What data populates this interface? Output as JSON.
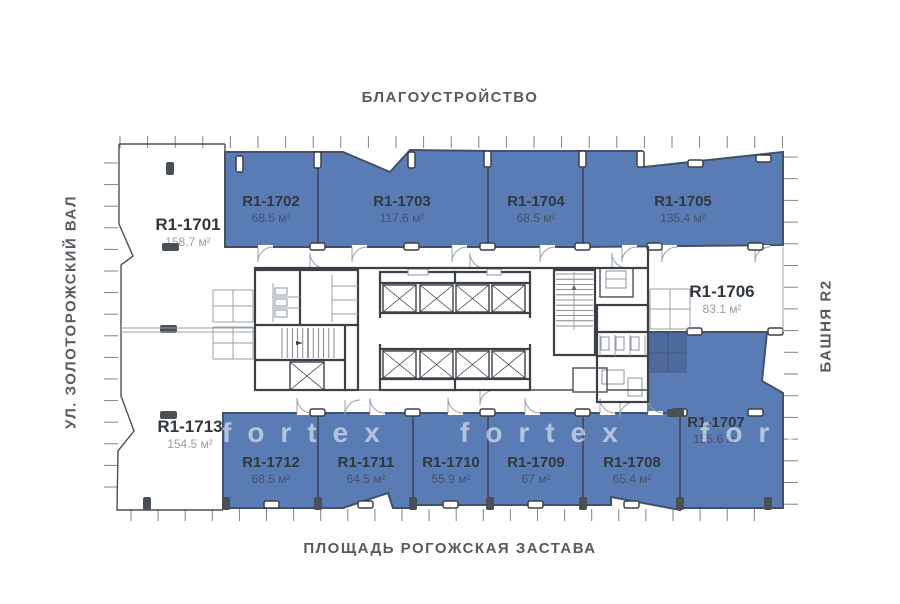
{
  "labels": {
    "top": "БЛАГОУСТРОЙСТВО",
    "left": "УЛ. ЗОЛОТОРОЖСКИЙ ВАЛ",
    "right": "БАШНЯ R2",
    "bottom": "ПЛОЩАДЬ РОГОЖСКАЯ ЗАСТАВА"
  },
  "watermark": {
    "text": "fortex",
    "tiles": [
      {
        "x": 222,
        "y": 442
      },
      {
        "x": 460,
        "y": 442
      },
      {
        "x": 700,
        "y": 442
      }
    ]
  },
  "colors": {
    "highlight_fill": "#5a7cb5",
    "highlight_border": "#43506a",
    "wall": "#3b4046",
    "unit_id_text": "#31373f",
    "area_text_on_blue": "#46526a",
    "area_text_on_white": "#989da5",
    "margin_label_text": "#565a61",
    "watermark_text": "rgba(255,255,255,0.55)"
  },
  "units": [
    {
      "id": "R1-1701",
      "area": "158.7 м²",
      "highlighted": false,
      "label": {
        "x": 188,
        "y": 230
      },
      "polygon": null
    },
    {
      "id": "R1-1702",
      "area": "68.5 м²",
      "highlighted": true,
      "label": {
        "x": 271,
        "y": 206
      },
      "polygon": [
        [
          225,
          152
        ],
        [
          318,
          152
        ],
        [
          318,
          247
        ],
        [
          225,
          247
        ]
      ]
    },
    {
      "id": "R1-1703",
      "area": "117.6 м²",
      "highlighted": true,
      "label": {
        "x": 402,
        "y": 206
      },
      "polygon": [
        [
          318,
          152
        ],
        [
          343,
          152
        ],
        [
          390,
          172
        ],
        [
          410,
          150
        ],
        [
          488,
          151
        ],
        [
          488,
          247
        ],
        [
          318,
          247
        ]
      ]
    },
    {
      "id": "R1-1704",
      "area": "68.5 м²",
      "highlighted": true,
      "label": {
        "x": 536,
        "y": 206
      },
      "polygon": [
        [
          488,
          151
        ],
        [
          583,
          151
        ],
        [
          583,
          247
        ],
        [
          488,
          247
        ]
      ]
    },
    {
      "id": "R1-1705",
      "area": "135.4 м²",
      "highlighted": true,
      "label": {
        "x": 683,
        "y": 206
      },
      "polygon": [
        [
          583,
          151
        ],
        [
          641,
          151
        ],
        [
          644,
          167
        ],
        [
          783,
          152
        ],
        [
          783,
          245
        ],
        [
          583,
          247
        ]
      ]
    },
    {
      "id": "R1-1706",
      "area": "83.1 м²",
      "highlighted": false,
      "label": {
        "x": 722,
        "y": 297
      },
      "polygon": null
    },
    {
      "id": "R1-1707",
      "area": "155.6 м²",
      "highlighted": true,
      "label": {
        "x": 716,
        "y": 427
      },
      "polygon": [
        [
          648,
          332
        ],
        [
          767,
          332
        ],
        [
          762,
          381
        ],
        [
          783,
          393
        ],
        [
          783,
          508
        ],
        [
          680,
          508
        ],
        [
          680,
          413
        ],
        [
          648,
          413
        ]
      ]
    },
    {
      "id": "R1-1708",
      "area": "65.4 м²",
      "highlighted": true,
      "label": {
        "x": 632,
        "y": 467
      },
      "polygon": [
        [
          583,
          413
        ],
        [
          680,
          413
        ],
        [
          680,
          510
        ],
        [
          611,
          497
        ],
        [
          611,
          505
        ],
        [
          583,
          505
        ]
      ]
    },
    {
      "id": "R1-1709",
      "area": "67 м²",
      "highlighted": true,
      "label": {
        "x": 536,
        "y": 467
      },
      "polygon": [
        [
          488,
          413
        ],
        [
          583,
          413
        ],
        [
          583,
          505
        ],
        [
          488,
          505
        ]
      ]
    },
    {
      "id": "R1-1710",
      "area": "55.9 м²",
      "highlighted": true,
      "label": {
        "x": 451,
        "y": 467
      },
      "polygon": [
        [
          413,
          413
        ],
        [
          488,
          413
        ],
        [
          488,
          505
        ],
        [
          413,
          505
        ]
      ]
    },
    {
      "id": "R1-1711",
      "area": "64.5 м²",
      "highlighted": true,
      "label": {
        "x": 366,
        "y": 467
      },
      "polygon": [
        [
          318,
          413
        ],
        [
          413,
          413
        ],
        [
          413,
          508
        ],
        [
          393,
          508
        ],
        [
          388,
          493
        ],
        [
          343,
          508
        ],
        [
          318,
          508
        ]
      ]
    },
    {
      "id": "R1-1712",
      "area": "68.5 м²",
      "highlighted": true,
      "label": {
        "x": 271,
        "y": 467
      },
      "polygon": [
        [
          223,
          413
        ],
        [
          318,
          413
        ],
        [
          318,
          508
        ],
        [
          223,
          508
        ]
      ]
    },
    {
      "id": "R1-1713",
      "area": "154.5 м²",
      "highlighted": false,
      "label": {
        "x": 190,
        "y": 432
      },
      "polygon": null
    }
  ]
}
